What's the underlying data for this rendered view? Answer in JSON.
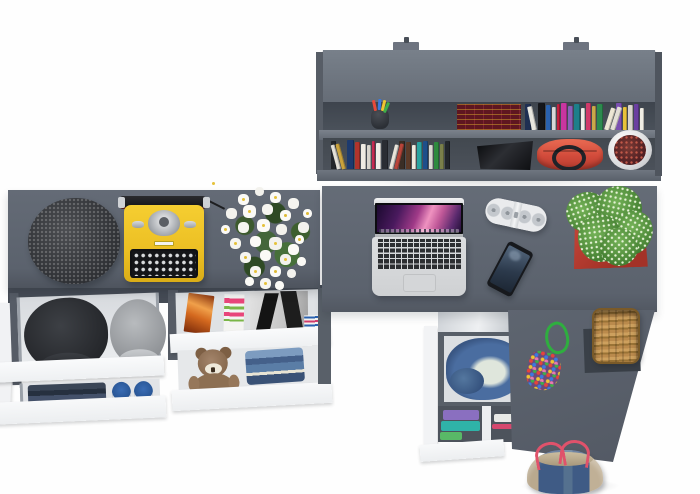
{
  "meta": {
    "description": "Overhead 3D render of a gray L-shaped desk workstation: wall shelf with books above, desks with typewriter, flowers and laptop, and open white drawers with clothes and accessories below",
    "text_visible": "none"
  },
  "palette": {
    "furniture_gray": "#5d646f",
    "furniture_gray_dark": "#454b55",
    "shelf_interior": "#454b54",
    "drawer_white": "#f6f7f9",
    "typewriter_yellow": "#eec42a",
    "plant_green": "#4f8f3a",
    "pot_red": "#b83a2e",
    "handbag_red": "#d94f3d",
    "denim_blue": "#44608a",
    "basket_tan": "#b8884c",
    "background": "#ffffff"
  },
  "objects": {
    "wall_shelf": "Wall-mounted shelf unit with books and accessories",
    "mount_tab": "Wall mounting bracket",
    "pencil_cup": "Cup with colored pens",
    "book_set_red": "Dark red book set with gold bands",
    "books_upper": "Row of colorful books (upper shelf)",
    "books_lower": "Row of books (lower shelf)",
    "black_device": "Black gadget on shelf",
    "red_handbag": "Red handbag with black handles",
    "white_planter": "White planter with dark red plant",
    "desk_left": "Left desk top",
    "desk_right": "Right L-shaped desk top",
    "desk_return": "Desk return panel",
    "beanie": "Dark speckled knit hat",
    "typewriter": "Yellow vintage typewriter",
    "flowers": "Bouquet of white daisies",
    "laptop": "Open silver laptop with purple wallpaper",
    "speaker": "White pill-shaped portable speaker",
    "smartphone": "Black smartphone",
    "potted_plant": "Green spiky plant in red pot",
    "drawer_caps": "Open drawer with black and gray caps",
    "cap_black": "Black cap",
    "cap_gray": "Gray cap",
    "drawer_clothes": "Drawer with folded dark clothes and blue sneakers",
    "drawer_magazines": "Open drawer with magazines and posters",
    "teddy_bear": "Brown teddy bear",
    "jeans_stack": "Folded jeans",
    "drawer_denim": "Open drawer with denim jacket",
    "clothes_shelf": "Open shelf with folded colorful clothes",
    "bead_pouch": "Multicolor beaded pouch with green cord",
    "wicker_basket": "Wicker basket on dark mat",
    "denim_bag": "Denim tote bag with red straps"
  },
  "shelf_books_upper": [
    {
      "c": "#1f2f52",
      "w": 6,
      "h": 26
    },
    {
      "c": "#e8e6df",
      "w": 5,
      "h": 24,
      "lean": -12
    },
    {
      "c": "#15161a",
      "w": 7,
      "h": 27
    },
    {
      "c": "#2a62b0",
      "w": 5,
      "h": 25
    },
    {
      "c": "#d8d8da",
      "w": 4,
      "h": 23
    },
    {
      "c": "#c2203f",
      "w": 3,
      "h": 26
    },
    {
      "c": "#c935a0",
      "w": 6,
      "h": 27
    },
    {
      "c": "#8a5fb8",
      "w": 5,
      "h": 24
    },
    {
      "c": "#1d7f8a",
      "w": 6,
      "h": 26
    },
    {
      "c": "#efefe9",
      "w": 4,
      "h": 22
    },
    {
      "c": "#d13a6a",
      "w": 5,
      "h": 27
    },
    {
      "c": "#caa84a",
      "w": 4,
      "h": 24
    },
    {
      "c": "#2c8a4e",
      "w": 6,
      "h": 26
    },
    {
      "c": "#ece6d4",
      "w": 5,
      "h": 23,
      "lean": 18
    },
    {
      "c": "#e3dfd6",
      "w": 5,
      "h": 24,
      "lean": 18
    },
    {
      "c": "#7a4fb0",
      "w": 6,
      "h": 27
    },
    {
      "c": "#e8c23a",
      "w": 4,
      "h": 23
    },
    {
      "c": "#d8d4cc",
      "w": 5,
      "h": 25
    },
    {
      "c": "#6a3fa0",
      "w": 5,
      "h": 26
    },
    {
      "c": "#f0ede4",
      "w": 4,
      "h": 22
    }
  ],
  "shelf_books_lower": [
    {
      "c": "#23262b",
      "w": 5,
      "h": 28
    },
    {
      "c": "#e3e0d8",
      "w": 4,
      "h": 25,
      "lean": -15
    },
    {
      "c": "#caa23c",
      "w": 4,
      "h": 26,
      "lean": -15
    },
    {
      "c": "#1d3a6e",
      "w": 7,
      "h": 29
    },
    {
      "c": "#b0342c",
      "w": 5,
      "h": 27
    },
    {
      "c": "#efece4",
      "w": 5,
      "h": 25
    },
    {
      "c": "#d8d5cd",
      "w": 4,
      "h": 24
    },
    {
      "c": "#c42b52",
      "w": 3,
      "h": 28
    },
    {
      "c": "#f0eee8",
      "w": 5,
      "h": 26
    },
    {
      "c": "#2a2d33",
      "w": 6,
      "h": 29
    },
    {
      "c": "#e8e4da",
      "w": 4,
      "h": 25,
      "lean": 14
    },
    {
      "c": "#b8453a",
      "w": 4,
      "h": 26,
      "lean": 14
    },
    {
      "c": "#3a2e26",
      "w": 6,
      "h": 28
    },
    {
      "c": "#5c3a28",
      "w": 5,
      "h": 27
    },
    {
      "c": "#efe9de",
      "w": 4,
      "h": 24
    },
    {
      "c": "#2aa3a0",
      "w": 5,
      "h": 27
    },
    {
      "c": "#1e4f8a",
      "w": 5,
      "h": 28
    },
    {
      "c": "#d8d8d2",
      "w": 4,
      "h": 24
    },
    {
      "c": "#2e8a3f",
      "w": 5,
      "h": 27
    },
    {
      "c": "#7a7f4a",
      "w": 4,
      "h": 25
    },
    {
      "c": "#23262b",
      "w": 5,
      "h": 28
    }
  ],
  "pencil_colors": [
    "#e84a3a",
    "#3a7ae0",
    "#efc532",
    "#3fae4a"
  ]
}
